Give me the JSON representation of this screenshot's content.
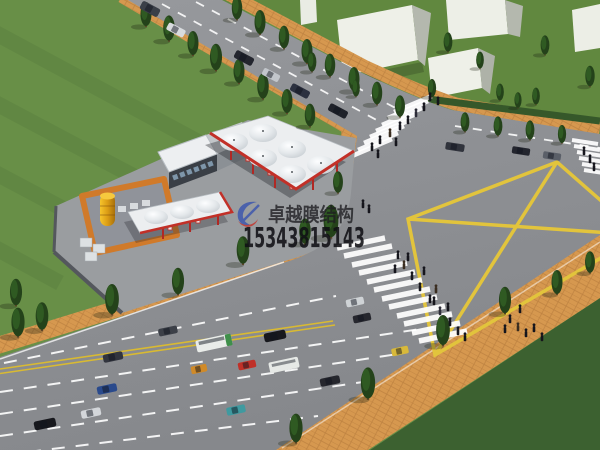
{
  "watermark": {
    "company_name": "卓越膜结构",
    "phone_number": "15343815143",
    "logo": "blue-red-swoosh-logo"
  },
  "scene": {
    "description": "Aerial 3D architectural rendering of a membrane-structure gas station at a large road intersection with traffic, trees, lawns and white massing buildings",
    "station": {
      "main_canopy_peaks": 6,
      "secondary_canopy_peaks": 3,
      "features": [
        "white membrane canopy with red trim",
        "station shop with flat roof",
        "fuel dispenser islands",
        "yellow storage tank",
        "orange tank-yard wall",
        "gray compound wall"
      ]
    },
    "roads": {
      "markings": [
        "dashed white lane lines",
        "double yellow center line",
        "yellow box-junction diamond",
        "zebra crosswalks"
      ],
      "crosswalk_count": 3,
      "vehicle_count_approx": 24
    },
    "environment": [
      "street trees",
      "lawns",
      "brick sidewalks",
      "pedestrians",
      "white box buildings"
    ]
  },
  "colors": {
    "grass": "#688f47",
    "grass_dark": "#3c6130",
    "asphalt": "#8c8e92",
    "sidewalk_brick": "#d6984f",
    "canopy_white": "#eceef0",
    "trim_red": "#c23028",
    "marking_yellow": "#e2c43c",
    "tank_yellow": "#e8a91e",
    "watermark_text": "#16161a",
    "logo_blue": "#3e57ae",
    "logo_red": "#c23830"
  }
}
